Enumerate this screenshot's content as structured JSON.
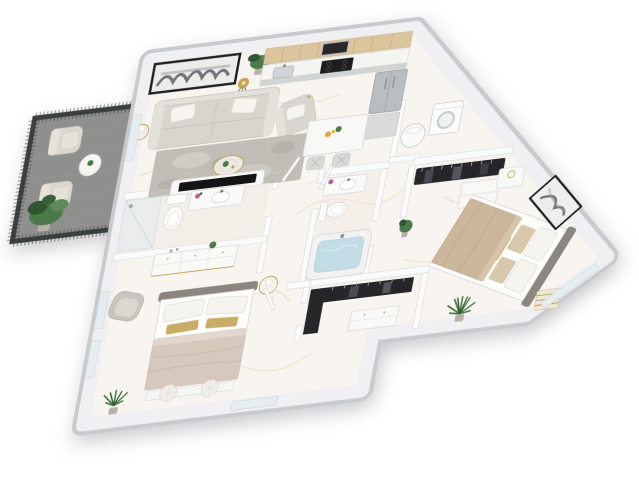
{
  "meta": {
    "scene": "3D isometric floor plan rendering",
    "unit_type": "two-bedroom two-bath apartment",
    "bedrooms": 2,
    "bathrooms": 2,
    "background": "white studio backdrop",
    "floor_finish": "white marble with gold veining"
  },
  "palette": {
    "floor": "#f8f5f0",
    "vein_gold": "#d8c28c",
    "vein_gray": "#e9e6e0",
    "band_outer": "#c9cace",
    "band_wall": "#f0f0f2",
    "balcony_floor": "#8f8f8d",
    "railing_dark": "#3b3f3e",
    "cabinet_wood": "#dcc49c",
    "cabinet_gray": "#ccd0cf",
    "counter_white": "#f4f4f1",
    "steel": "#b9bec1",
    "appliance_black": "#1d1d1f",
    "sofa": "#d9d5ce",
    "sofa_light": "#e4e1da",
    "rug": "#b7b4ad",
    "rug_light": "#d3d0c9",
    "rug_dark": "#a3a099",
    "pillow_white": "#f6f4ef",
    "gold": "#c2a14b",
    "gold_pillow": "#c9ad67",
    "bed1_blanket": "#d7c8be",
    "bed2_blanket": "#cbb69b",
    "tan_pillow": "#d8c8ab",
    "headboard": "#8b867f",
    "plant": "#4a7a49",
    "plant_dark": "#2f5531",
    "pot": "#b9b2a6",
    "water": "#c3dde6",
    "glass": "#e5edf0",
    "clothes": "#26262a",
    "art_frame": "#1f1f22",
    "tv_black": "#141416",
    "tile": "#efe9e2"
  },
  "rooms": {
    "living_room": {
      "name": "Living Room",
      "items": [
        "sofa",
        "white-pillows",
        "armchair",
        "area-rug",
        "coffee-table",
        "tv-console",
        "tv",
        "abstract-wall-art",
        "tripod-floor-lamp",
        "table-lamp",
        "side-table",
        "potted-plant"
      ]
    },
    "kitchen": {
      "name": "Kitchen",
      "items": [
        "wood-upper-cabinets",
        "gray-base-cabinets",
        "countertop",
        "sink",
        "black-cooktop",
        "microwave",
        "stainless-refrigerator",
        "tall-cabinet",
        "dining-table",
        "two-bar-chairs",
        "fruit-bowl",
        "vase-plant"
      ]
    },
    "balcony": {
      "name": "Balcony",
      "items": [
        "dark-mesh-railing",
        "two-armchairs",
        "round-side-table",
        "large-potted-plant"
      ]
    },
    "bathroom_1": {
      "name": "Bathroom 1",
      "items": [
        "glass-shower",
        "toilet",
        "vanity-with-sink",
        "flower-vase"
      ]
    },
    "bathroom_2": {
      "name": "Bathroom 2",
      "items": [
        "vanity-with-sink",
        "toilet",
        "bathtub-with-water",
        "flower-vase"
      ]
    },
    "utility_closet": {
      "name": "Utility Closet",
      "items": [
        "water-heater",
        "washer"
      ]
    },
    "reach_in_closet": {
      "name": "Reach-in Closet",
      "items": [
        "hanging-dark-clothes",
        "white-shelf-unit"
      ]
    },
    "walk_in_closet": {
      "name": "Walk-in Closet",
      "items": [
        "hanging-dark-clothes",
        "white-drawer-chest"
      ]
    },
    "bedroom_1": {
      "name": "Bedroom 1",
      "items": [
        "double-bed",
        "gray-headboard",
        "white-pillows",
        "gold-lumbar-pillows",
        "blush-blanket",
        "dresser",
        "accent-chair",
        "foot-bench",
        "two-tufted-poufs",
        "round-nightstand",
        "potted-plant",
        "windows"
      ]
    },
    "bedroom_2": {
      "name": "Bedroom 2",
      "items": [
        "double-bed",
        "gray-headboard",
        "white-pillows",
        "tan-pillows",
        "gold-lumbar-pillow",
        "tan-blanket",
        "nightstand",
        "striped-ottoman",
        "abstract-wall-art",
        "plant-stand",
        "palm-plant",
        "corner-window"
      ]
    },
    "hallway": {
      "name": "Hallway",
      "items": [
        "interior-doors",
        "entry-door"
      ]
    }
  }
}
